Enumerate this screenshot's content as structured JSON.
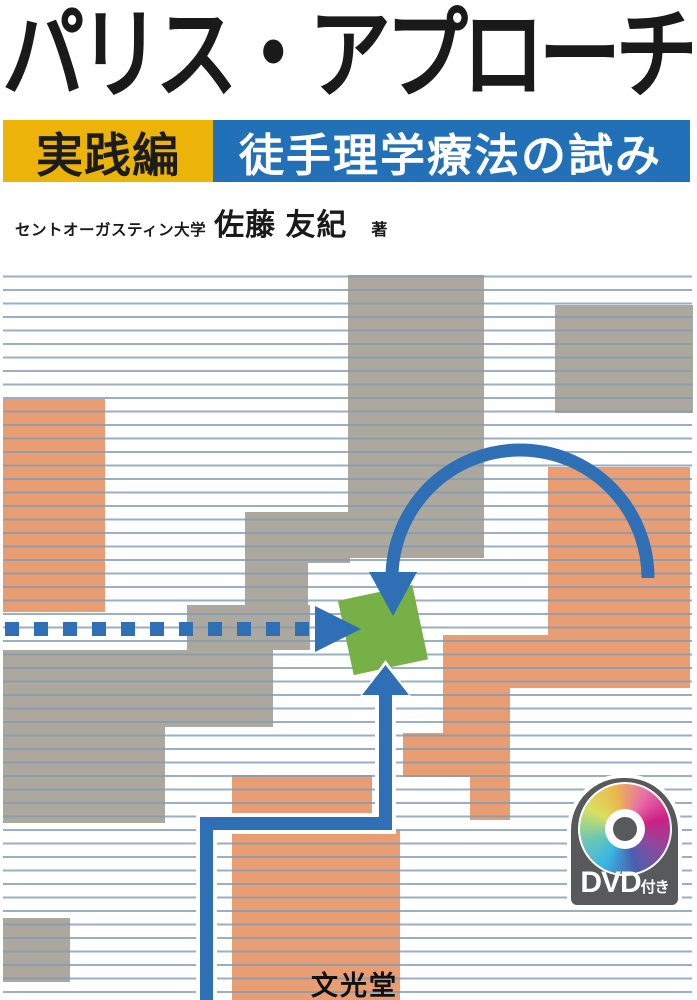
{
  "cover": {
    "title": "パリス・アプローチ",
    "edition_badge": "実践編",
    "subtitle": "徒手理学療法の試み",
    "author_affiliation": "セントオーガスティン大学",
    "author_name": "佐藤 友紀",
    "author_role": "著",
    "publisher": "文光堂",
    "dvd_badge": {
      "main": "DVD",
      "suffix": "付き"
    }
  },
  "colors": {
    "title_text": "#1A1A1A",
    "edition_badge_bg": "#ECB409",
    "subtitle_bg": "#2170B8",
    "subtitle_text": "#FFFFFF",
    "ruled_line": "#96B1C9",
    "block_gray": "#ACA89D",
    "block_salmon": "#E89D72",
    "arrow_blue": "#2E6FB6",
    "green_square": "#76B046",
    "dvd_badge_bg": "#58595B"
  }
}
